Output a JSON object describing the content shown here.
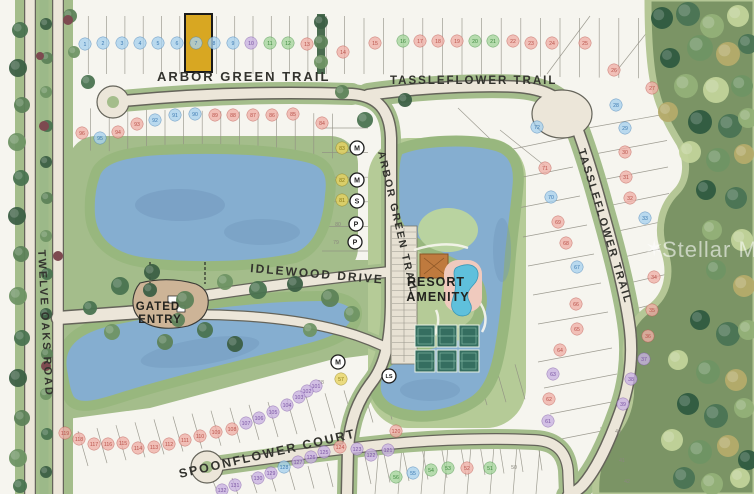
{
  "community_map": {
    "streets": {
      "arbor_green_trail_top": "ARBOR GREEN TRAIL",
      "arbor_green_trail_side": "ARBOR GREEN TRAIL",
      "tassleflower_trail_top": "TASSLEFLOWER TRAIL",
      "tassleflower_trail_side": "TASSLEFLOWER TRAIL",
      "twelve_oaks_road": "TWELVE OAKS ROAD",
      "idlewood_drive": "IDLEWOOD DRIVE",
      "spoonflower_court": "SPOONFLOWER COURT"
    },
    "areas": {
      "gated_entry_line1": "GATED",
      "gated_entry_line2": "ENTRY",
      "resort_amenity_line1": "RESORT",
      "resort_amenity_line2": "AMENITY"
    },
    "watermark": {
      "star": "✶",
      "text": "Stellar MLS"
    },
    "highlighted_lot": {
      "number": "7",
      "fill": "#d8a722"
    },
    "badge_colors": {
      "blue": "#a9d2ee",
      "pink": "#f0b0a8",
      "green": "#a5d69c",
      "purple": "#c9b2e2",
      "yellow": "#e8d460",
      "faint": "none"
    },
    "badge_text_colors": {
      "blue": "#3c7ab2",
      "pink": "#b9524a",
      "green": "#3f8a3f",
      "purple": "#7b55a4",
      "yellow": "#8a7a14",
      "faint": "#8a887e"
    },
    "utility_markers": [
      [
        "M",
        357,
        148
      ],
      [
        "M",
        357,
        180
      ],
      [
        "S",
        357,
        201
      ],
      [
        "P",
        356,
        224
      ],
      [
        "P",
        355,
        242
      ],
      [
        "M",
        338,
        362
      ],
      [
        "LS",
        389,
        376
      ]
    ],
    "lots": [
      [
        1,
        85,
        44,
        "blue"
      ],
      [
        2,
        103,
        43,
        "blue"
      ],
      [
        3,
        122,
        43,
        "blue"
      ],
      [
        4,
        140,
        43,
        "blue"
      ],
      [
        5,
        158,
        43,
        "blue"
      ],
      [
        6,
        177,
        43,
        "blue"
      ],
      [
        7,
        196,
        43,
        "blue"
      ],
      [
        8,
        214,
        43,
        "blue"
      ],
      [
        9,
        233,
        43,
        "blue"
      ],
      [
        10,
        251,
        43,
        "purple"
      ],
      [
        11,
        270,
        43,
        "green"
      ],
      [
        12,
        288,
        43,
        "green"
      ],
      [
        13,
        307,
        44,
        "pink"
      ],
      [
        14,
        343,
        52,
        "pink"
      ],
      [
        15,
        375,
        43,
        "pink"
      ],
      [
        16,
        403,
        41,
        "green"
      ],
      [
        17,
        420,
        41,
        "pink"
      ],
      [
        18,
        438,
        41,
        "pink"
      ],
      [
        19,
        457,
        41,
        "pink"
      ],
      [
        20,
        475,
        41,
        "green"
      ],
      [
        21,
        493,
        41,
        "green"
      ],
      [
        22,
        513,
        41,
        "pink"
      ],
      [
        23,
        531,
        43,
        "pink"
      ],
      [
        24,
        552,
        43,
        "pink"
      ],
      [
        25,
        585,
        43,
        "pink"
      ],
      [
        26,
        614,
        70,
        "pink"
      ],
      [
        27,
        652,
        88,
        "pink"
      ],
      [
        28,
        616,
        105,
        "blue"
      ],
      [
        29,
        625,
        128,
        "blue"
      ],
      [
        30,
        625,
        152,
        "pink"
      ],
      [
        31,
        626,
        177,
        "pink"
      ],
      [
        32,
        630,
        198,
        "pink"
      ],
      [
        33,
        645,
        218,
        "blue"
      ],
      [
        34,
        654,
        277,
        "pink"
      ],
      [
        35,
        652,
        310,
        "pink"
      ],
      [
        36,
        648,
        336,
        "pink"
      ],
      [
        37,
        644,
        359,
        "purple"
      ],
      [
        38,
        631,
        379,
        "purple"
      ],
      [
        39,
        623,
        404,
        "purple"
      ],
      [
        40,
        618,
        431,
        "faint"
      ],
      [
        41,
        622,
        460,
        "faint"
      ],
      [
        42,
        627,
        481,
        "faint"
      ],
      [
        50,
        514,
        467,
        "faint"
      ],
      [
        51,
        490,
        468,
        "green"
      ],
      [
        52,
        467,
        468,
        "pink"
      ],
      [
        53,
        448,
        468,
        "green"
      ],
      [
        54,
        431,
        470,
        "green"
      ],
      [
        55,
        413,
        473,
        "blue"
      ],
      [
        56,
        396,
        477,
        "green"
      ],
      [
        57,
        341,
        379,
        "yellow"
      ],
      [
        58,
        321,
        382,
        "faint"
      ],
      [
        61,
        548,
        421,
        "purple"
      ],
      [
        62,
        549,
        399,
        "pink"
      ],
      [
        63,
        553,
        374,
        "purple"
      ],
      [
        64,
        560,
        350,
        "pink"
      ],
      [
        65,
        577,
        329,
        "pink"
      ],
      [
        66,
        576,
        304,
        "pink"
      ],
      [
        67,
        577,
        267,
        "blue"
      ],
      [
        68,
        566,
        243,
        "pink"
      ],
      [
        69,
        558,
        222,
        "pink"
      ],
      [
        70,
        551,
        197,
        "blue"
      ],
      [
        71,
        545,
        168,
        "pink"
      ],
      [
        72,
        537,
        127,
        "blue"
      ],
      [
        79,
        336,
        242,
        "faint"
      ],
      [
        80,
        338,
        224,
        "faint"
      ],
      [
        81,
        342,
        200,
        "yellow"
      ],
      [
        82,
        342,
        180,
        "yellow"
      ],
      [
        83,
        342,
        148,
        "yellow"
      ],
      [
        84,
        322,
        123,
        "pink"
      ],
      [
        85,
        293,
        114,
        "pink"
      ],
      [
        86,
        272,
        115,
        "pink"
      ],
      [
        87,
        253,
        115,
        "pink"
      ],
      [
        88,
        233,
        115,
        "pink"
      ],
      [
        89,
        215,
        115,
        "pink"
      ],
      [
        90,
        195,
        114,
        "blue"
      ],
      [
        91,
        175,
        115,
        "blue"
      ],
      [
        92,
        155,
        120,
        "blue"
      ],
      [
        93,
        137,
        124,
        "pink"
      ],
      [
        94,
        118,
        132,
        "pink"
      ],
      [
        95,
        100,
        138,
        "blue"
      ],
      [
        96,
        82,
        133,
        "pink"
      ],
      [
        101,
        316,
        386,
        "purple"
      ],
      [
        102,
        307,
        391,
        "purple"
      ],
      [
        103,
        299,
        397,
        "purple"
      ],
      [
        104,
        287,
        405,
        "purple"
      ],
      [
        105,
        273,
        412,
        "purple"
      ],
      [
        106,
        259,
        418,
        "purple"
      ],
      [
        107,
        246,
        423,
        "purple"
      ],
      [
        108,
        232,
        429,
        "pink"
      ],
      [
        109,
        216,
        432,
        "pink"
      ],
      [
        110,
        200,
        436,
        "pink"
      ],
      [
        111,
        185,
        440,
        "pink"
      ],
      [
        112,
        169,
        444,
        "pink"
      ],
      [
        113,
        154,
        447,
        "pink"
      ],
      [
        114,
        138,
        448,
        "pink"
      ],
      [
        115,
        123,
        443,
        "pink"
      ],
      [
        116,
        108,
        444,
        "pink"
      ],
      [
        117,
        94,
        444,
        "pink"
      ],
      [
        118,
        79,
        439,
        "pink"
      ],
      [
        119,
        65,
        433,
        "pink"
      ],
      [
        120,
        396,
        431,
        "pink"
      ],
      [
        121,
        388,
        450,
        "purple"
      ],
      [
        122,
        371,
        455,
        "purple"
      ],
      [
        123,
        357,
        449,
        "purple"
      ],
      [
        124,
        340,
        447,
        "pink"
      ],
      [
        125,
        324,
        452,
        "purple"
      ],
      [
        126,
        311,
        457,
        "purple"
      ],
      [
        127,
        298,
        462,
        "purple"
      ],
      [
        128,
        284,
        467,
        "blue"
      ],
      [
        129,
        271,
        473,
        "purple"
      ],
      [
        130,
        258,
        478,
        "purple"
      ],
      [
        131,
        235,
        485,
        "purple"
      ],
      [
        132,
        222,
        490,
        "purple"
      ]
    ],
    "decor": {
      "trees": [
        [
          20,
          30,
          8
        ],
        [
          18,
          68,
          9
        ],
        [
          22,
          105,
          8
        ],
        [
          17,
          142,
          9
        ],
        [
          21,
          178,
          8
        ],
        [
          17,
          216,
          9
        ],
        [
          21,
          254,
          8
        ],
        [
          18,
          296,
          9
        ],
        [
          22,
          338,
          8
        ],
        [
          18,
          378,
          9
        ],
        [
          22,
          418,
          8
        ],
        [
          18,
          458,
          9
        ],
        [
          20,
          486,
          7
        ],
        [
          46,
          24,
          6
        ],
        [
          47,
          58,
          6
        ],
        [
          46,
          92,
          6
        ],
        [
          47,
          126,
          6
        ],
        [
          46,
          162,
          6
        ],
        [
          47,
          198,
          6
        ],
        [
          46,
          236,
          6
        ],
        [
          47,
          274,
          6
        ],
        [
          46,
          314,
          6
        ],
        [
          47,
          354,
          6
        ],
        [
          46,
          394,
          6
        ],
        [
          47,
          434,
          6
        ],
        [
          46,
          472,
          6
        ],
        [
          70,
          16,
          7
        ],
        [
          74,
          52,
          6
        ],
        [
          88,
          82,
          7
        ],
        [
          321,
          22,
          7
        ],
        [
          321,
          42,
          7
        ],
        [
          321,
          62,
          7
        ],
        [
          120,
          286,
          9
        ],
        [
          152,
          272,
          8
        ],
        [
          185,
          300,
          9
        ],
        [
          225,
          282,
          8
        ],
        [
          258,
          290,
          9
        ],
        [
          295,
          284,
          8
        ],
        [
          330,
          298,
          9
        ],
        [
          352,
          314,
          8
        ],
        [
          205,
          330,
          8
        ],
        [
          235,
          344,
          8
        ],
        [
          165,
          342,
          8
        ],
        [
          112,
          332,
          8
        ],
        [
          90,
          308,
          7
        ],
        [
          150,
          290,
          7
        ],
        [
          178,
          320,
          7
        ],
        [
          310,
          330,
          7
        ],
        [
          365,
          120,
          8
        ],
        [
          405,
          100,
          7
        ],
        [
          342,
          92,
          7
        ]
      ],
      "preserve_trees": [
        [
          662,
          18,
          11
        ],
        [
          688,
          14,
          12
        ],
        [
          712,
          26,
          12
        ],
        [
          738,
          16,
          11
        ],
        [
          700,
          48,
          13
        ],
        [
          728,
          54,
          12
        ],
        [
          670,
          58,
          10
        ],
        [
          748,
          44,
          10
        ],
        [
          686,
          86,
          12
        ],
        [
          716,
          90,
          13
        ],
        [
          742,
          86,
          11
        ],
        [
          668,
          112,
          10
        ],
        [
          700,
          122,
          12
        ],
        [
          730,
          126,
          12
        ],
        [
          748,
          118,
          10
        ],
        [
          690,
          152,
          11
        ],
        [
          718,
          160,
          12
        ],
        [
          744,
          154,
          10
        ],
        [
          706,
          190,
          10
        ],
        [
          736,
          198,
          11
        ],
        [
          712,
          230,
          10
        ],
        [
          742,
          240,
          11
        ],
        [
          716,
          270,
          10
        ],
        [
          744,
          286,
          11
        ],
        [
          700,
          320,
          10
        ],
        [
          728,
          334,
          12
        ],
        [
          748,
          330,
          10
        ],
        [
          678,
          360,
          10
        ],
        [
          708,
          372,
          12
        ],
        [
          736,
          380,
          11
        ],
        [
          688,
          404,
          11
        ],
        [
          716,
          416,
          12
        ],
        [
          744,
          408,
          10
        ],
        [
          672,
          440,
          11
        ],
        [
          700,
          452,
          12
        ],
        [
          728,
          446,
          11
        ],
        [
          748,
          460,
          10
        ],
        [
          684,
          478,
          11
        ],
        [
          712,
          484,
          11
        ],
        [
          740,
          478,
          10
        ]
      ],
      "bushes": [
        [
          44,
          126,
          5
        ],
        [
          58,
          256,
          5
        ],
        [
          46,
          366,
          5
        ],
        [
          68,
          20,
          5
        ],
        [
          40,
          56,
          4
        ]
      ]
    }
  }
}
